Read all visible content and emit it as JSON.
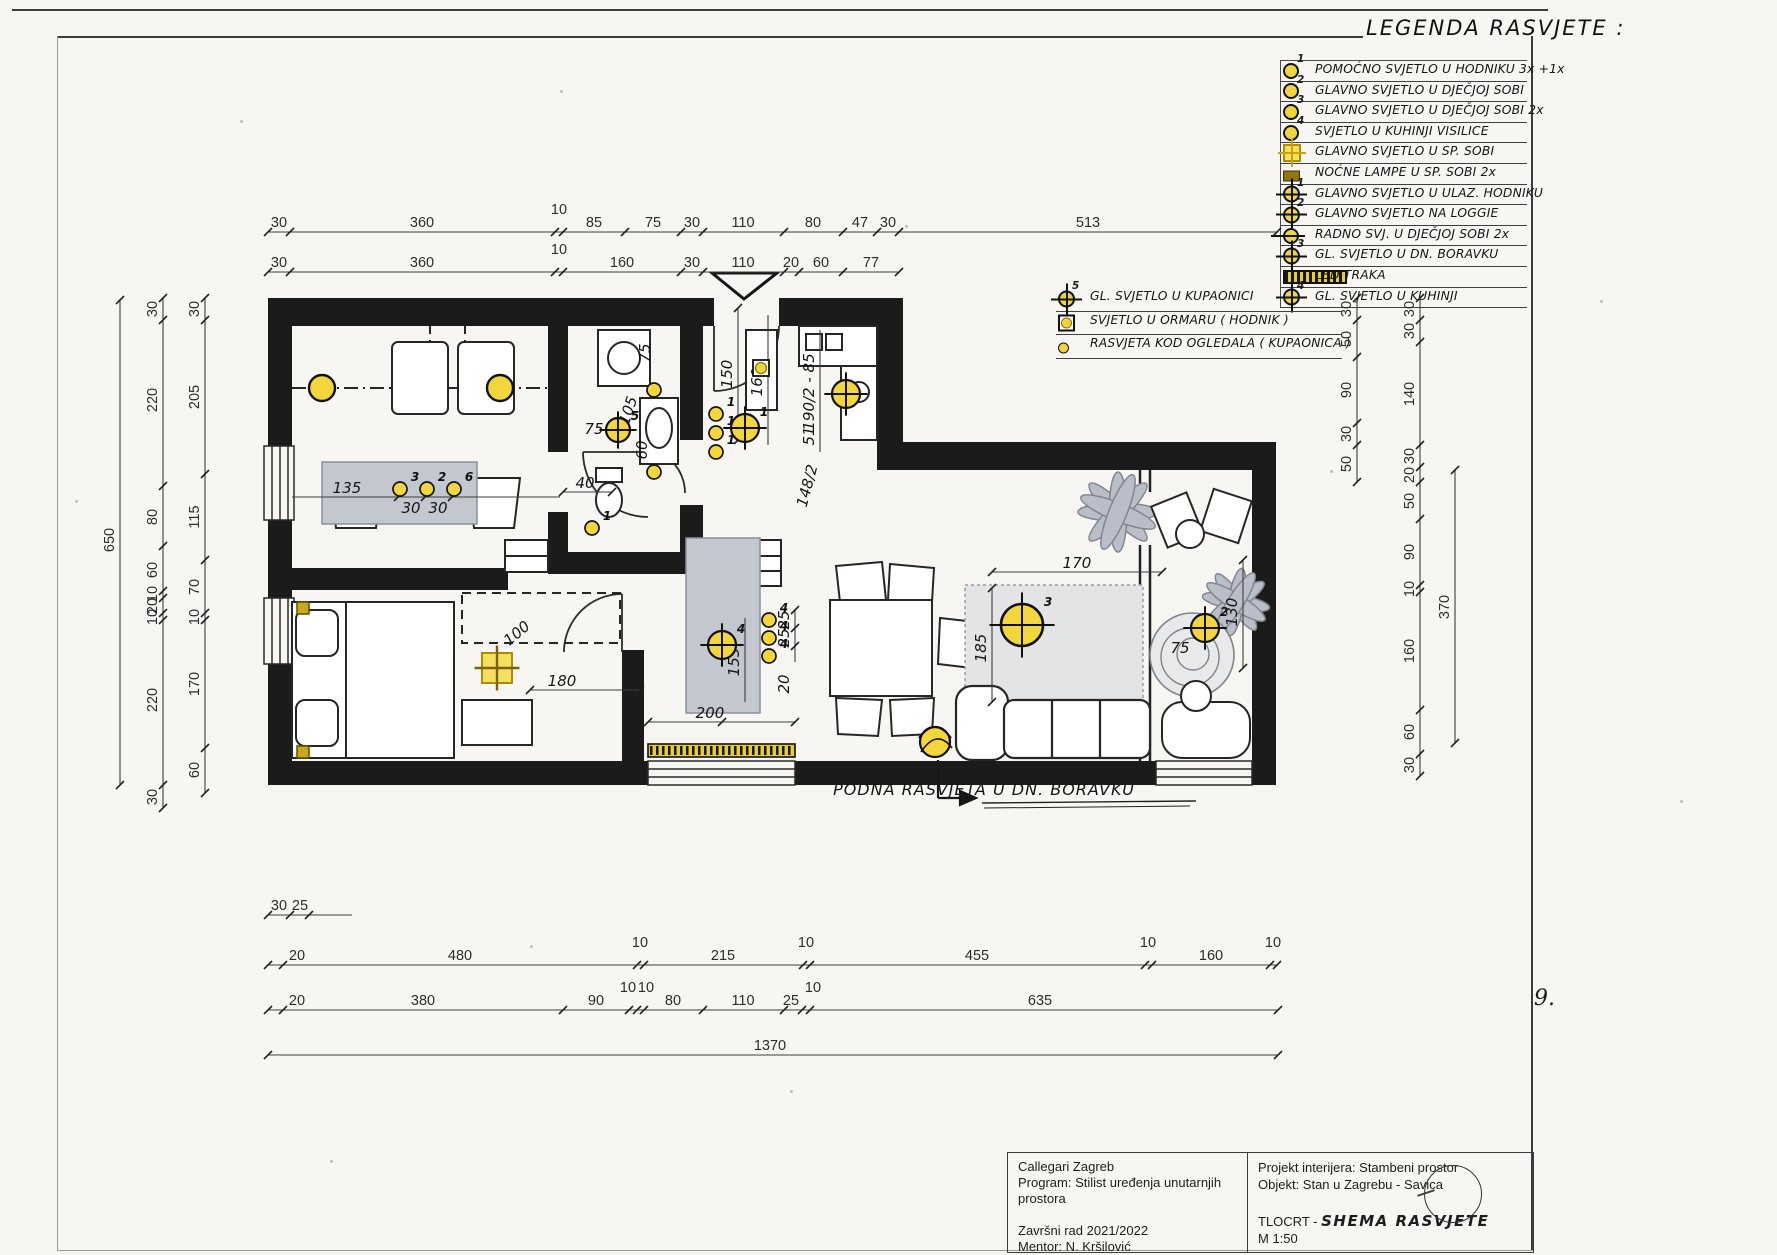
{
  "page": {
    "number": "9."
  },
  "legend": {
    "title": "LEGENDA RASVJETE :",
    "items": [
      {
        "symbol": "s-circle",
        "sup": "1",
        "label": "POMOĆNO SVJETLO U HODNIKU 3x +1x"
      },
      {
        "symbol": "s-circle",
        "sup": "2",
        "label": "GLAVNO SVJETLO U DJEČJOJ SOBI"
      },
      {
        "symbol": "s-circle",
        "sup": "3",
        "label": "GLAVNO SVJETLO U DJEČJOJ SOBI 2x"
      },
      {
        "symbol": "s-circle",
        "sup": "4",
        "label": "SVJETLO U KUHINJI  VISILICE"
      },
      {
        "symbol": "s-sqcross",
        "sup": "",
        "label": "GLAVNO SVJETLO U SP. SOBI"
      },
      {
        "symbol": "s-night",
        "sup": "",
        "label": "NOĆNE LAMPE U SP. SOBI 2x"
      },
      {
        "symbol": "s-cross",
        "sup": "1",
        "label": "GLAVNO SVJETLO U ULAZ. HODNIKU"
      },
      {
        "symbol": "s-cross",
        "sup": "2",
        "label": "GLAVNO SVJETLO NA LOGGIE"
      },
      {
        "symbol": "s-task",
        "sup": "",
        "label": "RADNO SVJ. U DJEČJOJ SOBI 2x"
      },
      {
        "symbol": "s-cross",
        "sup": "3",
        "label": "GL. SVJETLO U DN. BORAVKU"
      },
      {
        "symbol": "s-led",
        "sup": "",
        "label": "LED TRAKA"
      },
      {
        "symbol": "s-cross",
        "sup": "4",
        "label": "GL. SVJETLO U KUHINJI"
      }
    ],
    "extra_items": [
      {
        "symbol": "s-cross",
        "sup": "5",
        "label": "GL. SVJETLO U KUPAONICI"
      },
      {
        "symbol": "s-sqcircle",
        "sup": "",
        "label": "SVJETLO U ORMARU ( HODNIK )"
      },
      {
        "symbol": "s-mini",
        "sup": "",
        "label": "RASVJETA KOD OGLEDALA ( KUPAONICA )"
      }
    ]
  },
  "plan_annotation": "PODNA RASVJETA U DN. BORAVKU",
  "titleblock": {
    "left": [
      "Callegari Zagreb",
      "Program: Stilist uređenja unutarnjih prostora",
      "",
      "Završni rad 2021/2022",
      "Mentor: N. Kršilović",
      "Polaznica: Dina Kostanjčar"
    ],
    "right_line1": "Projekt interijera: Stambeni prostor",
    "right_line2": "Objekt: Stan u Zagrebu - Savica",
    "drawing_label": "TLOCRT -",
    "drawing_title": "SHEMA RASVJETE",
    "scale": "M 1:50"
  },
  "dims": {
    "h": [
      {
        "y": 232,
        "x1": 268,
        "x2": 1277,
        "ticks": [
          268,
          290,
          555,
          563,
          625,
          681,
          703,
          784,
          843,
          877,
          899,
          1277
        ],
        "labels": [
          {
            "t": "30",
            "x": 279
          },
          {
            "t": "360",
            "x": 422
          },
          {
            "t": "10",
            "x": 559,
            "dy": -18
          },
          {
            "t": "85",
            "x": 594
          },
          {
            "t": "75",
            "x": 653
          },
          {
            "t": "30",
            "x": 692
          },
          {
            "t": "110",
            "x": 743
          },
          {
            "t": "80",
            "x": 813
          },
          {
            "t": "47",
            "x": 860
          },
          {
            "t": "30",
            "x": 888
          },
          {
            "t": "513",
            "x": 1088
          }
        ]
      },
      {
        "y": 272,
        "x1": 268,
        "x2": 899,
        "ticks": [
          268,
          290,
          555,
          563,
          681,
          703,
          784,
          799,
          843,
          899
        ],
        "labels": [
          {
            "t": "30",
            "x": 279
          },
          {
            "t": "360",
            "x": 422
          },
          {
            "t": "10",
            "x": 559,
            "dy": -18
          },
          {
            "t": "160",
            "x": 622
          },
          {
            "t": "30",
            "x": 692
          },
          {
            "t": "110",
            "x": 743
          },
          {
            "t": "20",
            "x": 791
          },
          {
            "t": "60",
            "x": 821
          },
          {
            "t": "77",
            "x": 871
          }
        ]
      },
      {
        "y": 915,
        "x1": 268,
        "x2": 352,
        "ticks": [
          268,
          290,
          309
        ],
        "labels": [
          {
            "t": "30",
            "x": 279
          },
          {
            "t": "25",
            "x": 300
          }
        ]
      },
      {
        "y": 965,
        "x1": 268,
        "x2": 1277,
        "ticks": [
          268,
          283,
          637,
          644,
          803,
          810,
          1145,
          1152,
          1270,
          1277
        ],
        "labels": [
          {
            "t": "20",
            "x": 297
          },
          {
            "t": "480",
            "x": 460
          },
          {
            "t": "10",
            "x": 640,
            "dy": -18
          },
          {
            "t": "215",
            "x": 723
          },
          {
            "t": "10",
            "x": 806,
            "dy": -18
          },
          {
            "t": "455",
            "x": 977
          },
          {
            "t": "10",
            "x": 1148,
            "dy": -18
          },
          {
            "t": "160",
            "x": 1211
          },
          {
            "t": "10",
            "x": 1273,
            "dy": -18
          }
        ]
      },
      {
        "y": 1010,
        "x1": 268,
        "x2": 1278,
        "ticks": [
          268,
          283,
          563,
          629,
          637,
          644,
          703,
          784,
          802,
          810,
          1278
        ],
        "labels": [
          {
            "t": "20",
            "x": 297
          },
          {
            "t": "380",
            "x": 423
          },
          {
            "t": "90",
            "x": 596
          },
          {
            "t": "10",
            "x": 628,
            "dy": -18
          },
          {
            "t": "10",
            "x": 646,
            "dy": -18
          },
          {
            "t": "80",
            "x": 673
          },
          {
            "t": "110",
            "x": 743
          },
          {
            "t": "25",
            "x": 791
          },
          {
            "t": "10",
            "x": 813,
            "dy": -18
          },
          {
            "t": "635",
            "x": 1040
          }
        ]
      },
      {
        "y": 1055,
        "x1": 268,
        "x2": 1278,
        "ticks": [
          268,
          1278
        ],
        "labels": [
          {
            "t": "1370",
            "x": 770
          }
        ]
      },
      {
        "y": 572,
        "x1": 992,
        "x2": 1162,
        "ticks": [
          992,
          1162
        ],
        "labels": [
          {
            "t": "170",
            "x": 1077,
            "dy": -4,
            "hand": true
          }
        ]
      },
      {
        "y": 690,
        "x1": 530,
        "x2": 640,
        "ticks": [
          530,
          640
        ],
        "labels": [
          {
            "t": "180",
            "x": 562,
            "dy": -4,
            "hand": true
          }
        ]
      },
      {
        "y": 497,
        "x1": 292,
        "x2": 560,
        "ticks": [
          398,
          425,
          452
        ],
        "labels": [
          {
            "t": "135",
            "x": 347,
            "dy": -4,
            "hand": true
          },
          {
            "t": "30",
            "x": 411,
            "dy": 16,
            "hand": true
          },
          {
            "t": "30",
            "x": 438,
            "dy": 16,
            "hand": true
          }
        ]
      },
      {
        "y": 492,
        "x1": 563,
        "x2": 612,
        "ticks": [
          563,
          612
        ],
        "labels": [
          {
            "t": "40",
            "x": 585,
            "dy": -4,
            "hand": true
          }
        ]
      },
      {
        "y": 722,
        "x1": 648,
        "x2": 795,
        "ticks": [
          648,
          722,
          795
        ],
        "labels": [
          {
            "t": "200",
            "x": 710,
            "dy": -4,
            "hand": true
          }
        ]
      }
    ],
    "v": [
      {
        "x": 120,
        "y1": 300,
        "y2": 785,
        "ticks": [
          300,
          785
        ],
        "labels": [
          {
            "t": "650",
            "y": 540
          }
        ]
      },
      {
        "x": 163,
        "y1": 298,
        "y2": 808,
        "ticks": [
          298,
          320,
          486,
          546,
          591,
          598,
          613,
          620,
          785,
          808
        ],
        "labels": [
          {
            "t": "30",
            "y": 309
          },
          {
            "t": "220",
            "y": 400
          },
          {
            "t": "80",
            "y": 517
          },
          {
            "t": "60",
            "y": 570
          },
          {
            "t": "10",
            "y": 594
          },
          {
            "t": "20",
            "y": 606
          },
          {
            "t": "10",
            "y": 617
          },
          {
            "t": "220",
            "y": 700
          },
          {
            "t": "30",
            "y": 797
          }
        ]
      },
      {
        "x": 205,
        "y1": 298,
        "y2": 793,
        "ticks": [
          298,
          320,
          474,
          560,
          613,
          620,
          748,
          793
        ],
        "labels": [
          {
            "t": "30",
            "y": 309
          },
          {
            "t": "205",
            "y": 397
          },
          {
            "t": "115",
            "y": 517
          },
          {
            "t": "70",
            "y": 587
          },
          {
            "t": "10",
            "y": 617
          },
          {
            "t": "170",
            "y": 684
          },
          {
            "t": "60",
            "y": 770
          }
        ]
      },
      {
        "x": 1357,
        "y1": 298,
        "y2": 482,
        "ticks": [
          298,
          320,
          357,
          423,
          445,
          482
        ],
        "labels": [
          {
            "t": "30",
            "y": 309
          },
          {
            "t": "50",
            "y": 339
          },
          {
            "t": "90",
            "y": 390
          },
          {
            "t": "30",
            "y": 434
          },
          {
            "t": "50",
            "y": 464
          }
        ]
      },
      {
        "x": 1420,
        "y1": 298,
        "y2": 776,
        "ticks": [
          298,
          320,
          342,
          445,
          467,
          482,
          519,
          585,
          592,
          710,
          754,
          776
        ],
        "labels": [
          {
            "t": "30",
            "y": 309
          },
          {
            "t": "30",
            "y": 331
          },
          {
            "t": "140",
            "y": 394
          },
          {
            "t": "30",
            "y": 456
          },
          {
            "t": "20",
            "y": 475
          },
          {
            "t": "50",
            "y": 501
          },
          {
            "t": "90",
            "y": 552
          },
          {
            "t": "10",
            "y": 589
          },
          {
            "t": "160",
            "y": 651
          },
          {
            "t": "60",
            "y": 732
          },
          {
            "t": "30",
            "y": 765
          }
        ]
      },
      {
        "x": 1455,
        "y1": 470,
        "y2": 743,
        "ticks": [
          470,
          743
        ],
        "labels": [
          {
            "t": "370",
            "y": 607
          }
        ]
      },
      {
        "x": 992,
        "y1": 588,
        "y2": 702,
        "ticks": [
          588,
          702
        ],
        "labels": [
          {
            "t": "185",
            "y": 648,
            "hand": true
          }
        ]
      },
      {
        "x": 1243,
        "y1": 560,
        "y2": 668,
        "ticks": [
          560,
          668
        ],
        "labels": [
          {
            "t": "130",
            "y": 612,
            "hand": true
          }
        ]
      },
      {
        "x": 738,
        "y1": 308,
        "y2": 440,
        "ticks": [
          308,
          440
        ],
        "labels": [
          {
            "t": "150",
            "y": 374,
            "hand": true
          }
        ]
      },
      {
        "x": 768,
        "y1": 315,
        "y2": 445,
        "ticks": [],
        "labels": [
          {
            "t": "160",
            "y": 382,
            "hand": true
          }
        ]
      },
      {
        "x": 820,
        "y1": 330,
        "y2": 452,
        "ticks": [],
        "labels": [
          {
            "t": "190/2 - 85",
            "y": 392,
            "hand": true
          },
          {
            "t": "51",
            "y": 436,
            "hand": true
          }
        ]
      },
      {
        "x": 745,
        "y1": 618,
        "y2": 702,
        "ticks": [],
        "labels": [
          {
            "t": "155",
            "y": 662,
            "hand": true
          }
        ]
      },
      {
        "x": 795,
        "y1": 610,
        "y2": 662,
        "ticks": [
          610,
          628,
          646
        ],
        "labels": [
          {
            "t": "25",
            "y": 620,
            "hand": true
          },
          {
            "t": "25",
            "y": 638,
            "hand": true
          },
          {
            "t": "20",
            "y": 684,
            "hand": true
          }
        ]
      }
    ],
    "free": [
      {
        "t": "100",
        "x": 520,
        "y": 637,
        "r": -40
      },
      {
        "t": "75",
        "x": 1180,
        "y": 653
      },
      {
        "t": "75",
        "x": 650,
        "y": 353,
        "r": -90
      },
      {
        "t": "105",
        "x": 633,
        "y": 412,
        "r": -72
      },
      {
        "t": "60",
        "x": 647,
        "y": 450,
        "r": -90
      },
      {
        "t": "75",
        "x": 594,
        "y": 434
      },
      {
        "t": "148/2",
        "x": 812,
        "y": 487,
        "r": -75
      }
    ]
  },
  "lights": [
    {
      "type": "bulb",
      "x": 322,
      "y": 388,
      "r": 13
    },
    {
      "type": "bulb",
      "x": 500,
      "y": 388,
      "r": 13
    },
    {
      "type": "mini",
      "x": 400,
      "y": 489,
      "sup": "3"
    },
    {
      "type": "mini",
      "x": 427,
      "y": 489,
      "sup": "2"
    },
    {
      "type": "mini",
      "x": 454,
      "y": 489,
      "sup": "6"
    },
    {
      "type": "mini",
      "x": 592,
      "y": 528,
      "sup": "1"
    },
    {
      "type": "mini",
      "x": 716,
      "y": 414,
      "sup": "1"
    },
    {
      "type": "mini",
      "x": 716,
      "y": 433,
      "sup": "1"
    },
    {
      "type": "mini",
      "x": 716,
      "y": 452,
      "sup": "1"
    },
    {
      "type": "cross",
      "x": 745,
      "y": 428,
      "r": 14,
      "sup": "1"
    },
    {
      "type": "cross",
      "x": 846,
      "y": 394,
      "r": 14
    },
    {
      "type": "cross",
      "x": 618,
      "y": 430,
      "r": 12,
      "sup": "5"
    },
    {
      "type": "mini",
      "x": 654,
      "y": 390
    },
    {
      "type": "mini",
      "x": 654,
      "y": 472
    },
    {
      "type": "sqcircle",
      "x": 761,
      "y": 368
    },
    {
      "type": "cross",
      "x": 722,
      "y": 645,
      "r": 14,
      "sup": "4"
    },
    {
      "type": "mini",
      "x": 769,
      "y": 620,
      "sup": "4"
    },
    {
      "type": "mini",
      "x": 769,
      "y": 638,
      "sup": "4"
    },
    {
      "type": "mini",
      "x": 769,
      "y": 656,
      "sup": "4"
    },
    {
      "type": "cross-lg",
      "x": 1022,
      "y": 625,
      "r": 21,
      "sup": "3"
    },
    {
      "type": "cross",
      "x": 1205,
      "y": 628,
      "r": 14,
      "sup": "2"
    },
    {
      "type": "sqcross",
      "x": 497,
      "y": 668,
      "s": 30
    },
    {
      "type": "floor",
      "x": 935,
      "y": 742,
      "r": 15
    },
    {
      "type": "nightsq",
      "x": 303,
      "y": 608
    },
    {
      "type": "nightsq",
      "x": 303,
      "y": 752
    }
  ]
}
